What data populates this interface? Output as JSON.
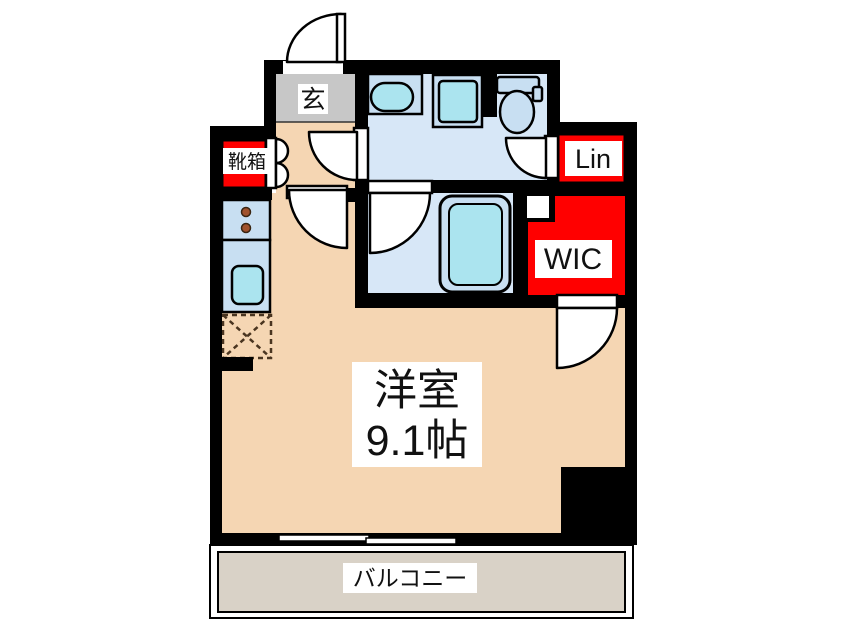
{
  "floor_plan": {
    "colors": {
      "wall": "#000000",
      "room_floor": "#f5d6b3",
      "entrance_floor": "#c7c7c7",
      "wet_area_floor": "#d7e7f7",
      "fixture_blue": "#c8dff2",
      "fixture_cyan": "#abe4ef",
      "closet_red": "#ff0000",
      "balcony_floor": "#d9d2c7",
      "label_background": "#ffffff",
      "text": "#111111",
      "burner_brown": "#a0522d",
      "fridge_dash_brown": "#4a3520"
    },
    "rooms": {
      "entrance": {
        "label": "玄"
      },
      "shoe_cabinet": {
        "label": "靴箱"
      },
      "linen_closet": {
        "label": "Lin"
      },
      "walk_in_closet": {
        "label": "WIC"
      },
      "main_room": {
        "name": "洋室",
        "size": "9.1帖"
      },
      "balcony": {
        "label": "バルコニー"
      }
    },
    "fixtures": [
      "entrance-door-swing-icon",
      "shoe-cabinet-door-icon",
      "stove-burners-icon",
      "kitchen-sink-icon",
      "fridge-space-icon",
      "wash-basin-icon",
      "washing-machine-pan-icon",
      "toilet-icon",
      "bathtub-icon",
      "sliding-window-icon"
    ]
  }
}
